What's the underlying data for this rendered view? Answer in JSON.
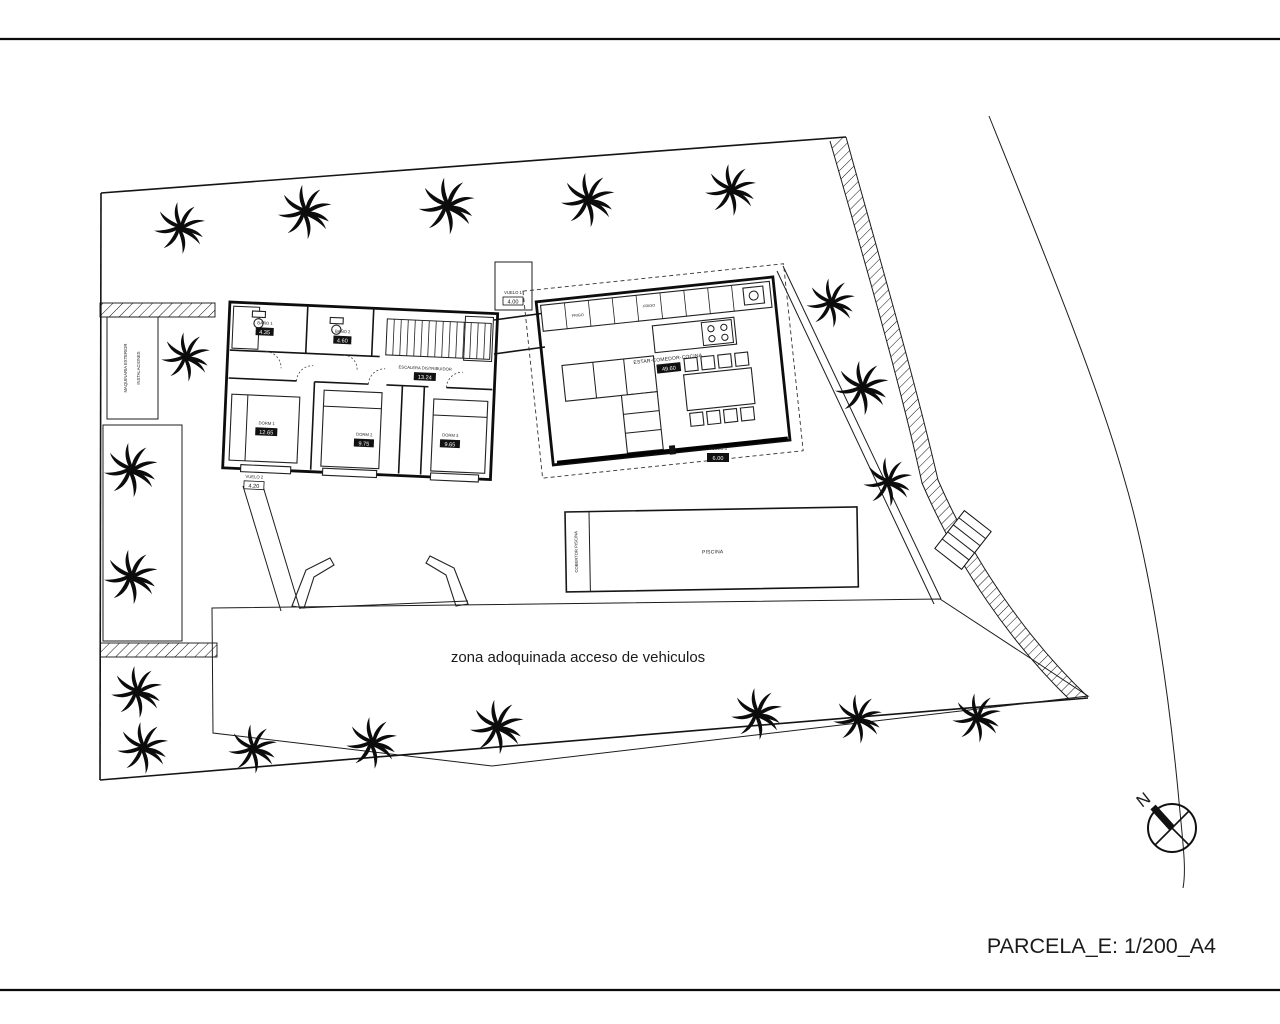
{
  "title_block": {
    "scale_label": "PARCELA_E: 1/200_A4"
  },
  "annotations": {
    "paved_zone": "zona adoquinada acceso de vehiculos",
    "north": "N",
    "machinery_line1": "MAQUINARIA EXTERIOR",
    "machinery_line2": "INSTALACIONES"
  },
  "rooms": {
    "bano1": {
      "name": "BAÑO 1",
      "area": "4.35"
    },
    "bano2": {
      "name": "BAÑO 2",
      "area": "4.60"
    },
    "escalera": {
      "name": "ESCALERA DISTRIBUIDOR",
      "area": "13.24"
    },
    "dorm1": {
      "name": "DORM 1",
      "area": "12.65"
    },
    "dorm2": {
      "name": "DORM 2",
      "area": "9.75"
    },
    "dorm3": {
      "name": "DORM 3",
      "area": "9.65"
    },
    "estar": {
      "name": "ESTAR-COMEDOR-COCINA",
      "area": "49.60"
    }
  },
  "overhangs": {
    "v1": {
      "name": "VUELO 1",
      "value": "4.00"
    },
    "v2": {
      "name": "VUELO 2",
      "value": "4.20"
    },
    "v3": {
      "name": "VUELO 3",
      "value": "6.00"
    }
  },
  "pool": {
    "label": "PISCINA",
    "cover_label": "COBERTOR PISCINA"
  },
  "kitchen": {
    "fridge_label": "FRIGO"
  },
  "colors": {
    "ink": "#111111",
    "paper": "#ffffff"
  }
}
